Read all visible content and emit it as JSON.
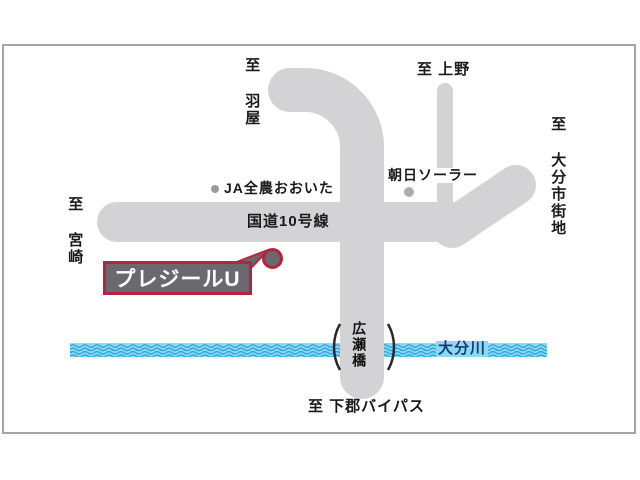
{
  "map": {
    "colors": {
      "road": "#d3d3d5",
      "river_base": "#8cd9f4",
      "river_wave": "#2fa6d9",
      "river_text": "#1c3c71",
      "poi_box": "#6a696d",
      "poi_accent": "#b5243f",
      "marker_gray": "#a4a4a8",
      "frame_border": "#a5a5a9",
      "text": "#1a1a1a"
    },
    "labels": {
      "to_haneya": "至 羽屋",
      "to_ueno": "至 上野",
      "to_oita_city": "至 大分市街地",
      "to_miyazaki": "至 宮崎",
      "ja_zennoh_oita": "JA全農おおいた",
      "route_10": "国道10号線",
      "asahi_solar": "朝日ソーラー",
      "oita_river": "大分川",
      "hirose_bridge": "広瀬橋",
      "to_shimogori_bypass": "至 下郡バイパス"
    },
    "poi": {
      "name": "プレジールU"
    }
  }
}
